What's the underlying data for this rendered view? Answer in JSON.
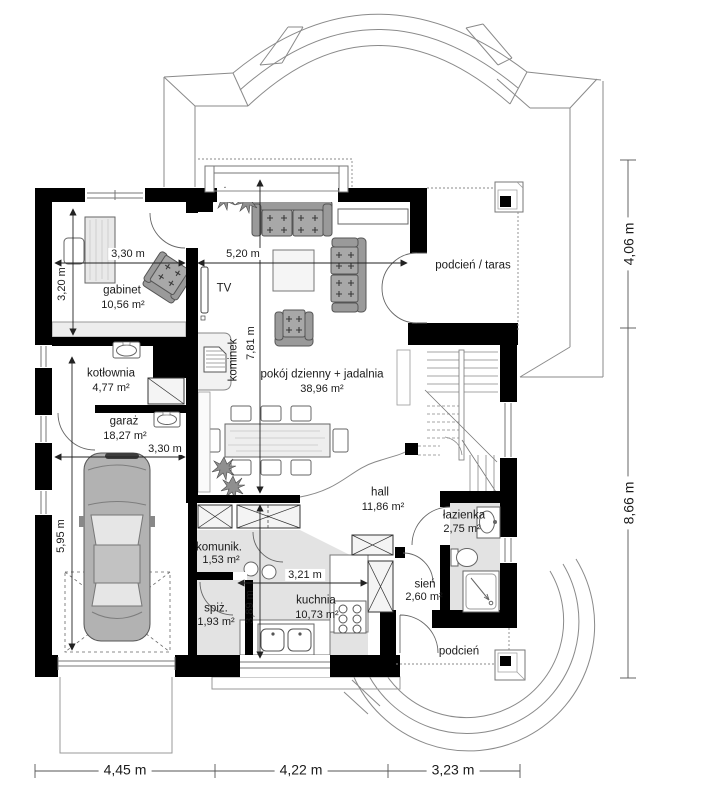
{
  "plan": {
    "rooms": [
      {
        "name": "gabinet",
        "area": "10,56 m²"
      },
      {
        "name": "kotłownia",
        "area": "4,77 m²"
      },
      {
        "name": "garaż",
        "area": "18,27 m²"
      },
      {
        "name": "pokój dzienny + jadalnia",
        "area": "38,96 m²"
      },
      {
        "name": "hall",
        "area": "11,86 m²"
      },
      {
        "name": "łazienka",
        "area": "2,75 m²"
      },
      {
        "name": "komunik.",
        "area": "1,53 m²"
      },
      {
        "name": "spiż.",
        "area": "1,93 m²"
      },
      {
        "name": "kuchnia",
        "area": "10,73 m²"
      },
      {
        "name": "sień",
        "area": "2,60 m²"
      },
      {
        "name": "podcień / taras",
        "area": ""
      },
      {
        "name": "podcień",
        "area": ""
      }
    ],
    "annotations": {
      "tv": "TV",
      "fireplace": "kominek"
    },
    "dims": {
      "gabinet_w": "3,30 m",
      "living_w": "5,20 m",
      "gabinet_h": "3,20 m",
      "living_h": "7,81 m",
      "garage_w": "3,30 m",
      "garage_h": "5,95 m",
      "kitchen_w": "3,21 m",
      "kitchen_h": "3,89 m",
      "right_top": "4,06 m",
      "right_bottom": "8,66 m",
      "bottom_left": "4,45 m",
      "bottom_mid": "4,22 m",
      "bottom_right": "3,23 m"
    },
    "colors": {
      "wall": "#000000",
      "floor_gray": "#e3e3e3",
      "furniture_gray": "#a5a5a5",
      "line": "#777777"
    }
  }
}
